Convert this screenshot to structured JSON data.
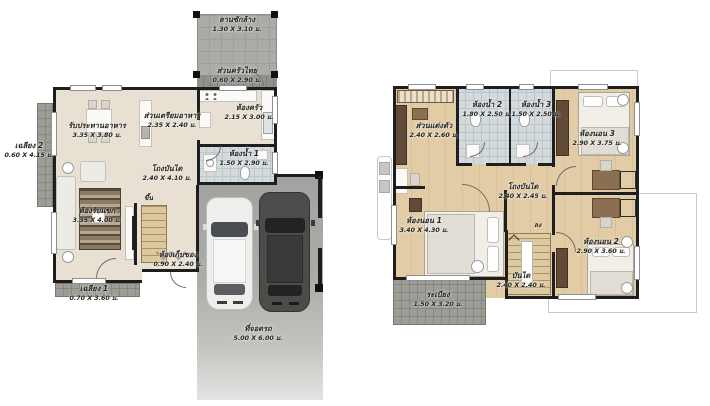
{
  "colors": {
    "wall": "#1e1e1e",
    "floor_beige": "#e8e0d3",
    "floor_wood": "#ddc7a0",
    "tile_bath": "#d3dadd",
    "tile_porch": "#9d9d97",
    "driveway_gray": "#a8a8a5",
    "stairs_wood": "#dbc89e",
    "roof_outline": "#c9c9c9",
    "label_text": "#26241f",
    "car_white": "#eeeeec",
    "car_dark": "#4c4c4a"
  },
  "floor1": {
    "rooms": {
      "washing_yard": {
        "name": "ลานซักล้าง",
        "dims": "1.30 X 3.10 ม."
      },
      "thai_kitchen": {
        "name": "ส่วนครัวไทย",
        "dims": "0.60 X 2.90 ม."
      },
      "kitchen": {
        "name": "ห้องครัว",
        "dims": "2.15 X 3.00 ม."
      },
      "bathroom1": {
        "name": "ห้องน้ำ 1",
        "dims": "1.50 X 2.90 ม."
      },
      "prep_area": {
        "name": "ส่วนเตรียมอาหาร",
        "dims": "2.35 X 2.40 ม."
      },
      "dining": {
        "name": "รับประทานอาหาร",
        "dims": "3.35 X 3.80 ม."
      },
      "porch2": {
        "name": "เฉลียง 2",
        "dims": "0.60 X 4.15 ม."
      },
      "living": {
        "name": "ห้องรับแขก",
        "dims": "3.35 X 4.00 ม."
      },
      "stair_hall": {
        "name": "โถงบันได",
        "dims": "2.40 X 4.10 ม."
      },
      "storage": {
        "name": "ห้องเก็บของ",
        "dims": "0.90 X 2.40 ม."
      },
      "porch1": {
        "name": "เฉลียง 1",
        "dims": "0.70 X 3.60 ม."
      },
      "parking": {
        "name": "ที่จอดรถ",
        "dims": "5.00 X 6.00 ม."
      },
      "up": "ขึ้น"
    }
  },
  "floor2": {
    "rooms": {
      "dressing": {
        "name": "ส่วนแต่งตัว",
        "dims": "2.40 X 2.60 ม."
      },
      "bathroom2": {
        "name": "ห้องน้ำ 2",
        "dims": "1.80 X 2.50 ม."
      },
      "bathroom3": {
        "name": "ห้องน้ำ 3",
        "dims": "1.50 X 2.50 ม."
      },
      "bedroom3": {
        "name": "ห้องนอน 3",
        "dims": "2.90 X 3.75 ม."
      },
      "stair_hall": {
        "name": "โถงบันได",
        "dims": "2.40 X 2.45 ม."
      },
      "bedroom1": {
        "name": "ห้องนอน 1",
        "dims": "3.40 X 4.30 ม."
      },
      "stairs": {
        "name": "บันได",
        "dims": "2.40 X 2.40 ม."
      },
      "bedroom2": {
        "name": "ห้องนอน 2",
        "dims": "2.90 X 3.60 ม."
      },
      "balcony": {
        "name": "ระเบียง",
        "dims": "1.50 X 3.20 ม."
      },
      "down": "ลง"
    }
  }
}
